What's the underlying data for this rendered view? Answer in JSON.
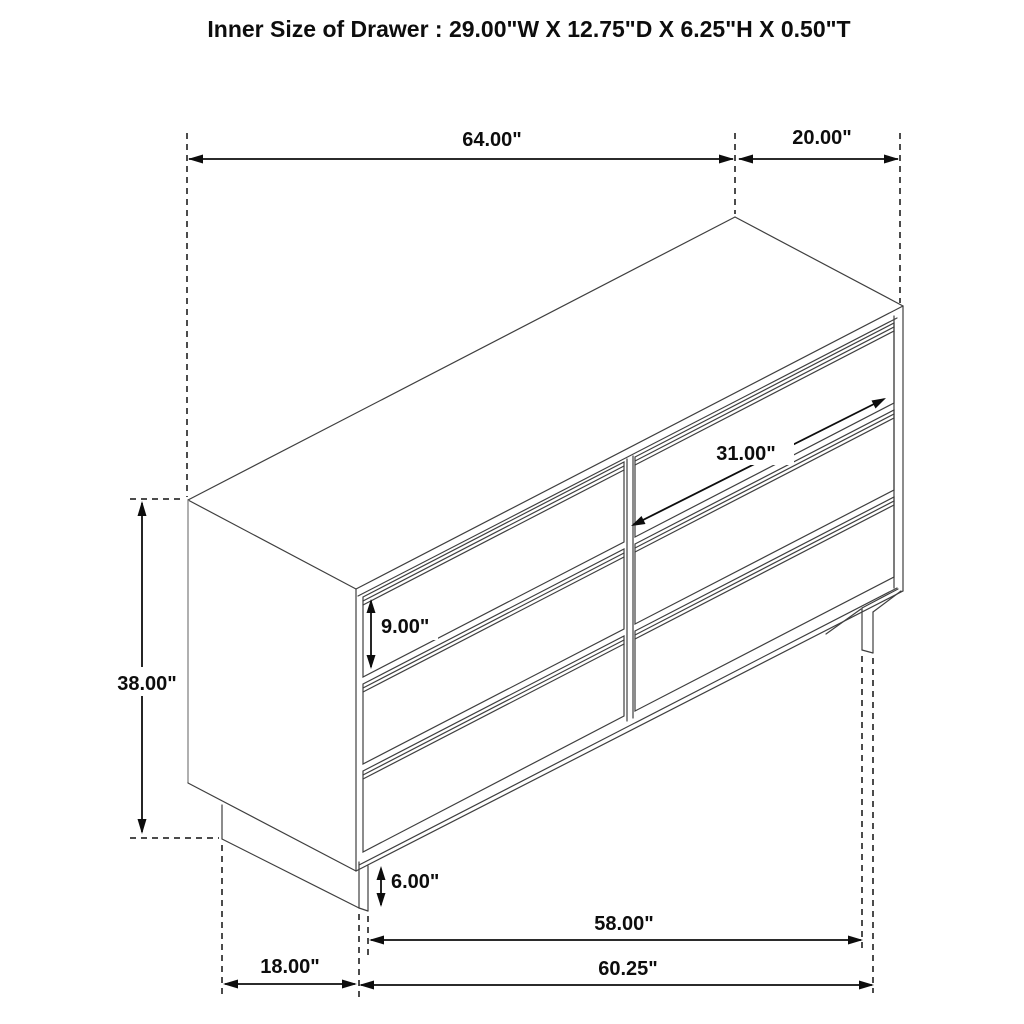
{
  "title": "Inner Size of Drawer : 29.00\"W X 12.75\"D X 6.25\"H X 0.50\"T",
  "dimensions": {
    "top_width": "64.00\"",
    "top_depth": "20.00\"",
    "overall_height": "38.00\"",
    "drawer_inner_diagonal": "31.00\"",
    "drawer_front_height": "9.00\"",
    "base_height": "6.00\"",
    "base_front_width": "58.00\"",
    "overall_floor_width": "60.25\"",
    "base_side_depth": "18.00\""
  },
  "figure": {
    "drawer_count": 6,
    "drawer_columns": 2,
    "drawer_rows": 3
  },
  "colors": {
    "background": "#ffffff",
    "cabinet_line": "#3f3f3f",
    "cabinet_line_light": "#8f8f8f",
    "dimension_line": "#0d0d0d",
    "text": "#0d0d0d"
  }
}
